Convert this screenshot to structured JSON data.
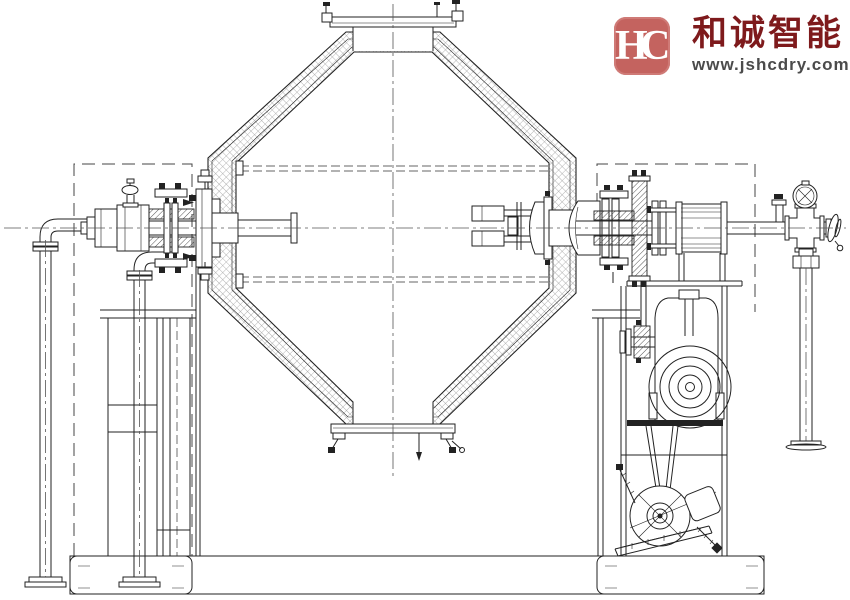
{
  "branding": {
    "monogram": "HC",
    "company_name": "和诚智能",
    "website": "www.jshcdry.com",
    "stamp_color": "#c4635f",
    "company_text_color": "#7e1a1c",
    "website_text_color": "#4b4b4b"
  },
  "drawing": {
    "line_color": "#222222",
    "background_color": "#ffffff",
    "hatch_color": "#999999"
  }
}
